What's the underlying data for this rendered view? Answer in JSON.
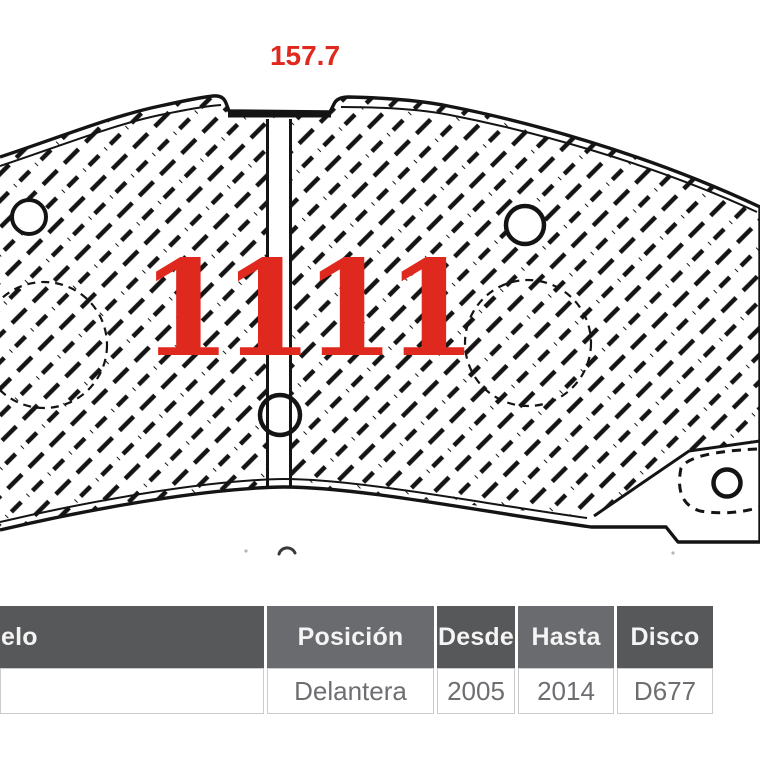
{
  "diagram": {
    "dimension_label": "157.7",
    "part_number": "1111",
    "accent_color": "#e0291e",
    "line_color": "#141414",
    "shapes": [
      "brake-pad-outline",
      "hatch-fill",
      "center-slot",
      "center-hole",
      "mounting-hole-left",
      "mounting-hole-right",
      "piston-contact-circle-left",
      "piston-contact-circle-right",
      "hidden-ear-outline",
      "ear-hole",
      "reference-arc"
    ]
  },
  "table": {
    "header_colors": {
      "dark": "#57585a",
      "medium": "#6a6b6e"
    },
    "border_color": "#c9cbcd",
    "text_color": "#6d6e71",
    "columns": [
      {
        "header": "elo",
        "value": ""
      },
      {
        "header": "Posición",
        "value": "Delantera"
      },
      {
        "header": "Desde",
        "value": "2005"
      },
      {
        "header": "Hasta",
        "value": "2014"
      },
      {
        "header": "Disco",
        "value": "D677"
      }
    ]
  }
}
